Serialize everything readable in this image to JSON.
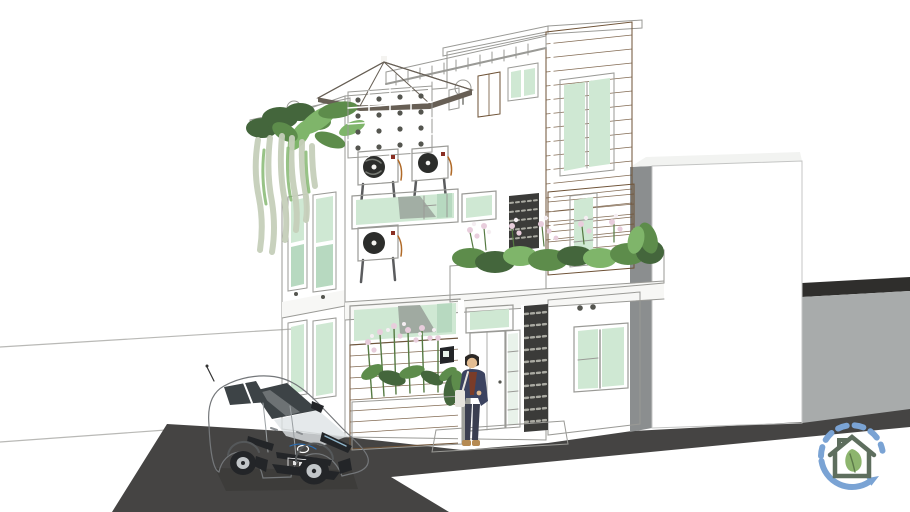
{
  "scene": {
    "title": "3D exterior render of a modern three-story townhouse with rooftop terrace",
    "elements": [
      "three-story-house",
      "rooftop-terrace",
      "patio-umbrella",
      "globe-lamps",
      "breeze-block-screen",
      "air-conditioner-units",
      "wood-clad-tower",
      "balcony-planter-flowers",
      "cascading-plants",
      "entry-door",
      "person-at-entrance",
      "concrete-planter",
      "white-hatchback-car",
      "asphalt-driveway",
      "neighboring-white-volume",
      "boundary-wall",
      "eco-house-watermark-logo"
    ]
  },
  "watermark": {
    "icon": "eco-house-cycle-logo"
  },
  "colors": {
    "background": "#ffffff",
    "line_faint": "#b9b9b6",
    "edge": "#5b5c5e",
    "asphalt": "#454443",
    "asphalt_dark": "#343331",
    "wall_white": "#fdfdfc",
    "wall_shadow": "#e1e1de",
    "slab": "#f7f7f5",
    "box_face": "#e8e9e8",
    "box_top": "#f2f3f1",
    "box_side": "#8b8e8f",
    "rightwall_face": "#a8abab",
    "rightwall_top": "#2f2e2c",
    "wood": "#8d6c4b",
    "wood_dark": "#7f6044",
    "wood_line": "#6e5236",
    "glass": "#cfe8d3",
    "glass_shade": "#b7d9c0",
    "glass_light": "#e9f2ea",
    "frame_white": "#ffffff",
    "frame_line": "#9a9a96",
    "lattice_dark": "#3b3b39",
    "lattice_dot": "#54554f",
    "perforation": "#aaaaa2",
    "panel_light": "#dcdcd8",
    "ac_fan": "#2c2d2b",
    "umbrella": "#948c81",
    "umbrella_dark": "#675f55",
    "foliage_dark": "#44663c",
    "foliage": "#5d8c4b",
    "foliage_light": "#7fb56a",
    "vine": "#c6cfba",
    "flower": "#e8cddc",
    "flower_light": "#f5eef2",
    "stem": "#557a42",
    "concrete": "#b4b6b1",
    "concrete_side": "#9fa19c",
    "step": "#cbcbc7",
    "silhouette": "#9aa39b",
    "car_body": "#f4f5f6",
    "car_shade": "#dfe3e6",
    "car_glass": "#3d4346",
    "car_dark": "#232528",
    "car_trim": "#6f7377",
    "plate": "#16244d",
    "toyota_blue": "#2b6fb5",
    "skin": "#e4bd92",
    "hair": "#2c2825",
    "jacket": "#3c4360",
    "shirt": "#7b3c28",
    "pants": "#3a3e50",
    "shoe": "#b58a53",
    "bag": "#e6e4de",
    "lamp_globe": "#f4f3f0",
    "logo_blue": "#7aa3d4",
    "logo_house": "#5e6e5e",
    "logo_leaf": "#8db56e"
  }
}
